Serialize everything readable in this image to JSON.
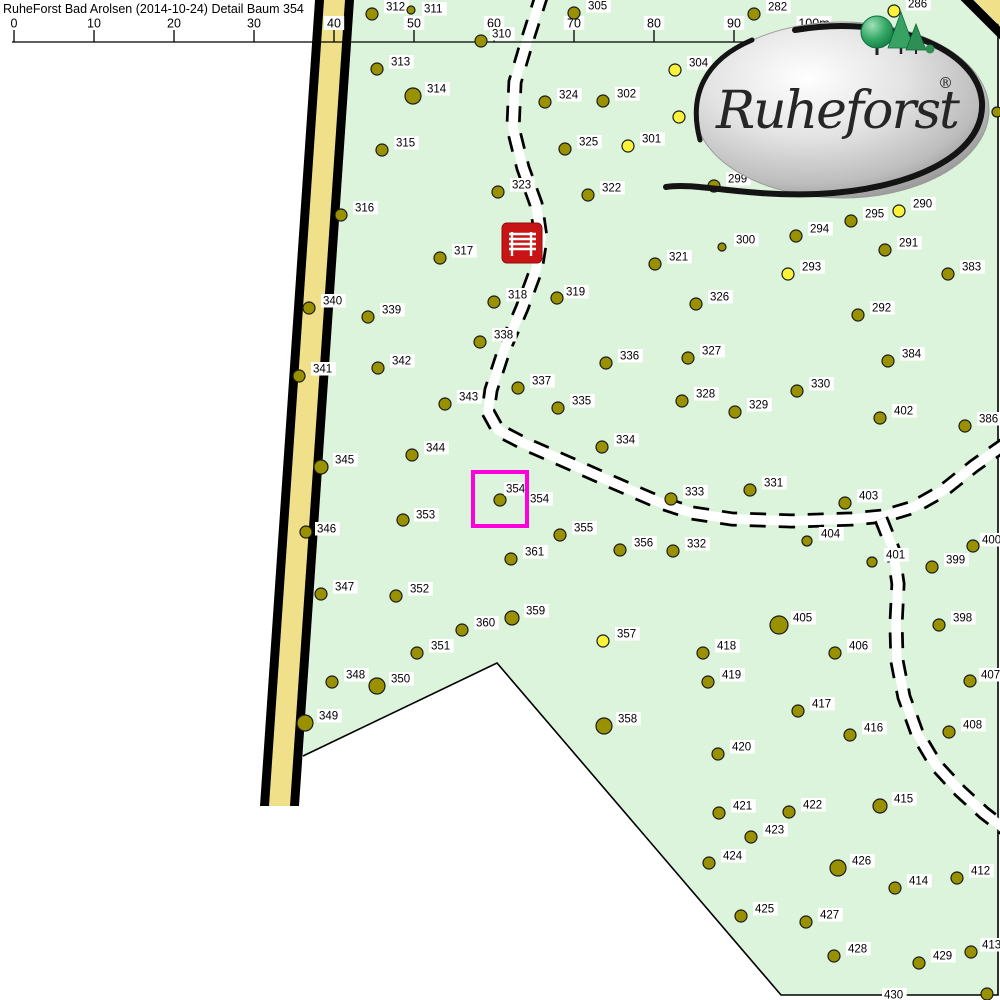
{
  "header": {
    "title": "RuheForst Bad Arolsen (2014-10-24) Detail Baum 354"
  },
  "logo": {
    "text": "Ruheforst",
    "registered": "®"
  },
  "colors": {
    "forest_green": "#DCF4DC",
    "road_yellow": "#F0E08A",
    "road_border": "#000000",
    "tree_olive": "#9A9100",
    "tree_yellow": "#FAF339",
    "tree_outline": "#1a1a1a",
    "label_bg": "#FFFFFF",
    "label_text": "#000000",
    "selection_magenta": "#FF00DC",
    "bench_red": "#C81414",
    "path_white": "#FFFFFF",
    "path_dash": "#000000"
  },
  "scale_bar": {
    "line": {
      "x1": 12,
      "x2": 822,
      "y": 42
    },
    "ticks": [
      {
        "label": "0",
        "x": 14
      },
      {
        "label": "10",
        "x": 94
      },
      {
        "label": "20",
        "x": 174
      },
      {
        "label": "30",
        "x": 254
      },
      {
        "label": "40",
        "x": 334
      },
      {
        "label": "50",
        "x": 414
      },
      {
        "label": "60",
        "x": 494
      },
      {
        "label": "70",
        "x": 574
      },
      {
        "label": "80",
        "x": 654
      },
      {
        "label": "90",
        "x": 734
      },
      {
        "label": "100m",
        "x": 814
      }
    ]
  },
  "map": {
    "selected_tree": "354",
    "selection": {
      "box": {
        "x": 473,
        "y": 472,
        "w": 54,
        "h": 54
      },
      "labels": [
        {
          "text": "354",
          "x": 506,
          "y": 482
        },
        {
          "text": "354",
          "x": 530,
          "y": 492
        }
      ]
    },
    "bench": {
      "x": 502,
      "y": 223,
      "w": 40,
      "h": 40
    },
    "paths": [
      {
        "name": "trail-main",
        "pts": [
          [
            542,
            -6
          ],
          [
            528,
            38
          ],
          [
            515,
            82
          ],
          [
            513,
            128
          ],
          [
            523,
            168
          ],
          [
            536,
            204
          ],
          [
            541,
            238
          ],
          [
            536,
            270
          ],
          [
            522,
            308
          ],
          [
            504,
            350
          ],
          [
            491,
            390
          ],
          [
            488,
            412
          ],
          [
            498,
            430
          ],
          [
            523,
            443
          ],
          [
            562,
            460
          ],
          [
            612,
            482
          ],
          [
            656,
            501
          ],
          [
            692,
            513
          ],
          [
            732,
            519
          ],
          [
            792,
            521
          ],
          [
            852,
            519
          ],
          [
            884,
            516
          ],
          [
            914,
            507
          ],
          [
            944,
            490
          ],
          [
            974,
            466
          ],
          [
            1008,
            442
          ]
        ]
      },
      {
        "name": "trail-south",
        "pts": [
          [
            881,
            519
          ],
          [
            893,
            549
          ],
          [
            898,
            584
          ],
          [
            896,
            624
          ],
          [
            897,
            661
          ],
          [
            904,
            697
          ],
          [
            917,
            733
          ],
          [
            936,
            765
          ],
          [
            960,
            791
          ],
          [
            984,
            813
          ],
          [
            1010,
            833
          ]
        ]
      }
    ],
    "trees": [
      {
        "n": "312",
        "x": 372,
        "y": 14
      },
      {
        "n": "311",
        "x": 411,
        "y": 10,
        "r": 4,
        "lx": 424,
        "ly": 2
      },
      {
        "n": "310",
        "x": 481,
        "y": 41,
        "lx": 492,
        "ly": 27
      },
      {
        "n": "305",
        "x": 574,
        "y": 13
      },
      {
        "n": "282",
        "x": 754,
        "y": 14
      },
      {
        "n": "286",
        "x": 894,
        "y": 11,
        "c": "y"
      },
      {
        "n": "304",
        "x": 675,
        "y": 70,
        "c": "y"
      },
      {
        "n": "",
        "x": 679,
        "y": 117,
        "c": "y"
      },
      {
        "n": "",
        "x": 997,
        "y": 112,
        "r": 5
      },
      {
        "n": "313",
        "x": 377,
        "y": 69
      },
      {
        "n": "314",
        "x": 413,
        "y": 96,
        "r": 8
      },
      {
        "n": "324",
        "x": 545,
        "y": 102
      },
      {
        "n": "302",
        "x": 603,
        "y": 101
      },
      {
        "n": "301",
        "x": 628,
        "y": 146,
        "c": "y"
      },
      {
        "n": "325",
        "x": 565,
        "y": 149
      },
      {
        "n": "315",
        "x": 382,
        "y": 150
      },
      {
        "n": "323",
        "x": 498,
        "y": 192
      },
      {
        "n": "322",
        "x": 588,
        "y": 195
      },
      {
        "n": "299",
        "x": 714,
        "y": 186
      },
      {
        "n": "316",
        "x": 341,
        "y": 215
      },
      {
        "n": "290",
        "x": 899,
        "y": 211,
        "c": "y"
      },
      {
        "n": "295",
        "x": 851,
        "y": 221
      },
      {
        "n": "294",
        "x": 796,
        "y": 236
      },
      {
        "n": "300",
        "x": 722,
        "y": 247,
        "r": 4
      },
      {
        "n": "291",
        "x": 885,
        "y": 250
      },
      {
        "n": "317",
        "x": 440,
        "y": 258
      },
      {
        "n": "321",
        "x": 655,
        "y": 264
      },
      {
        "n": "293",
        "x": 788,
        "y": 274,
        "c": "y"
      },
      {
        "n": "383",
        "x": 948,
        "y": 274
      },
      {
        "n": "326",
        "x": 696,
        "y": 304
      },
      {
        "n": "292",
        "x": 858,
        "y": 315
      },
      {
        "n": "318",
        "x": 494,
        "y": 302
      },
      {
        "n": "319",
        "x": 557,
        "y": 298,
        "lx": 566,
        "ly": 285
      },
      {
        "n": "340",
        "x": 309,
        "y": 308
      },
      {
        "n": "339",
        "x": 368,
        "y": 317
      },
      {
        "n": "338",
        "x": 480,
        "y": 342
      },
      {
        "n": "336",
        "x": 606,
        "y": 363
      },
      {
        "n": "327",
        "x": 688,
        "y": 358
      },
      {
        "n": "384",
        "x": 888,
        "y": 361
      },
      {
        "n": "342",
        "x": 378,
        "y": 368
      },
      {
        "n": "341",
        "x": 299,
        "y": 376
      },
      {
        "n": "337",
        "x": 518,
        "y": 388
      },
      {
        "n": "330",
        "x": 797,
        "y": 391
      },
      {
        "n": "335",
        "x": 558,
        "y": 408
      },
      {
        "n": "328",
        "x": 682,
        "y": 401
      },
      {
        "n": "402",
        "x": 880,
        "y": 418
      },
      {
        "n": "386",
        "x": 965,
        "y": 426
      },
      {
        "n": "343",
        "x": 445,
        "y": 404
      },
      {
        "n": "329",
        "x": 735,
        "y": 412
      },
      {
        "n": "334",
        "x": 602,
        "y": 447
      },
      {
        "n": "344",
        "x": 412,
        "y": 455
      },
      {
        "n": "345",
        "x": 321,
        "y": 467,
        "r": 7
      },
      {
        "n": "331",
        "x": 750,
        "y": 490
      },
      {
        "n": "333",
        "x": 671,
        "y": 499
      },
      {
        "n": "403",
        "x": 845,
        "y": 503
      },
      {
        "n": "354",
        "x": 500,
        "y": 500
      },
      {
        "n": "353",
        "x": 403,
        "y": 520,
        "lx": 416,
        "ly": 508
      },
      {
        "n": "346",
        "x": 306,
        "y": 532,
        "lx": 317,
        "ly": 522
      },
      {
        "n": "355",
        "x": 560,
        "y": 535
      },
      {
        "n": "356",
        "x": 620,
        "y": 550
      },
      {
        "n": "332",
        "x": 673,
        "y": 551
      },
      {
        "n": "404",
        "x": 807,
        "y": 541,
        "r": 5
      },
      {
        "n": "401",
        "x": 872,
        "y": 562,
        "r": 5
      },
      {
        "n": "399",
        "x": 932,
        "y": 567
      },
      {
        "n": "400",
        "x": 973,
        "y": 546,
        "lx": 982,
        "ly": 533
      },
      {
        "n": "361",
        "x": 511,
        "y": 559
      },
      {
        "n": "347",
        "x": 321,
        "y": 594
      },
      {
        "n": "352",
        "x": 396,
        "y": 596
      },
      {
        "n": "359",
        "x": 512,
        "y": 618,
        "r": 7
      },
      {
        "n": "360",
        "x": 462,
        "y": 630
      },
      {
        "n": "351",
        "x": 417,
        "y": 653
      },
      {
        "n": "357",
        "x": 603,
        "y": 641,
        "c": "y"
      },
      {
        "n": "405",
        "x": 779,
        "y": 625,
        "r": 9
      },
      {
        "n": "418",
        "x": 703,
        "y": 653
      },
      {
        "n": "406",
        "x": 835,
        "y": 653
      },
      {
        "n": "419",
        "x": 708,
        "y": 682
      },
      {
        "n": "348",
        "x": 332,
        "y": 682
      },
      {
        "n": "350",
        "x": 377,
        "y": 686,
        "r": 8
      },
      {
        "n": "417",
        "x": 798,
        "y": 711
      },
      {
        "n": "416",
        "x": 850,
        "y": 735
      },
      {
        "n": "358",
        "x": 604,
        "y": 726,
        "r": 8
      },
      {
        "n": "398",
        "x": 939,
        "y": 625
      },
      {
        "n": "407",
        "x": 970,
        "y": 681,
        "lx": 981,
        "ly": 668
      },
      {
        "n": "408",
        "x": 949,
        "y": 732
      },
      {
        "n": "349",
        "x": 305,
        "y": 723,
        "r": 8
      },
      {
        "n": "420",
        "x": 718,
        "y": 754
      },
      {
        "n": "421",
        "x": 719,
        "y": 813
      },
      {
        "n": "422",
        "x": 789,
        "y": 812
      },
      {
        "n": "415",
        "x": 880,
        "y": 806,
        "r": 7
      },
      {
        "n": "423",
        "x": 751,
        "y": 837
      },
      {
        "n": "424",
        "x": 709,
        "y": 863
      },
      {
        "n": "426",
        "x": 838,
        "y": 868,
        "r": 8
      },
      {
        "n": "414",
        "x": 895,
        "y": 888
      },
      {
        "n": "412",
        "x": 957,
        "y": 878
      },
      {
        "n": "425",
        "x": 741,
        "y": 916
      },
      {
        "n": "427",
        "x": 806,
        "y": 922
      },
      {
        "n": "428",
        "x": 834,
        "y": 956
      },
      {
        "n": "429",
        "x": 919,
        "y": 963
      },
      {
        "n": "413",
        "x": 971,
        "y": 952,
        "lx": 982,
        "ly": 938
      },
      {
        "n": "430",
        "x": 987,
        "y": 994,
        "lx": 884,
        "ly": 988
      }
    ]
  }
}
